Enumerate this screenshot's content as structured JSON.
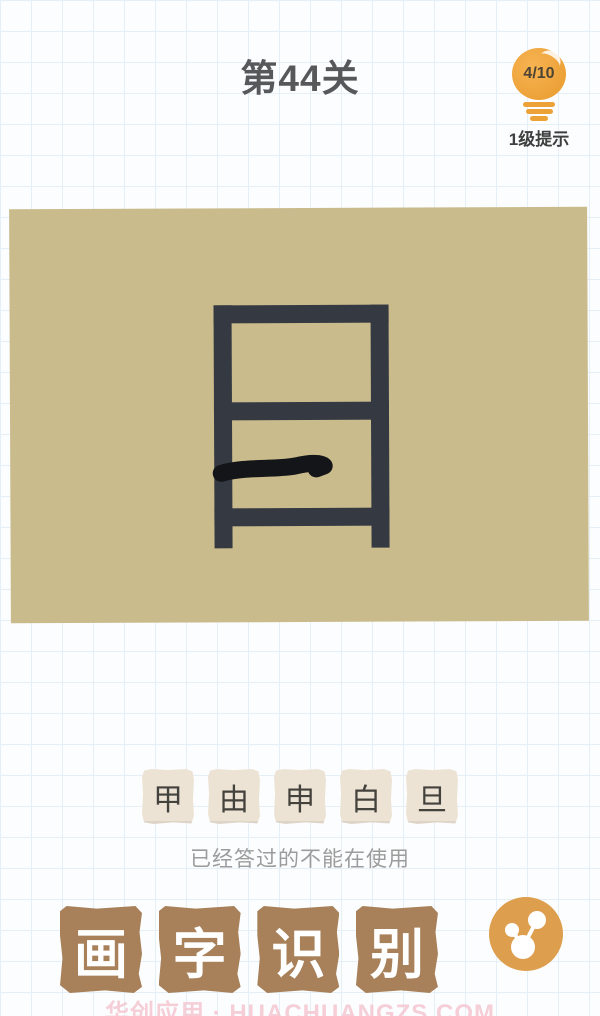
{
  "header": {
    "level_title": "第44关",
    "hint": {
      "count": "4/10",
      "label": "1级提示",
      "icon": "lightbulb-icon"
    }
  },
  "puzzle": {
    "base_shape": "日-frame with vertical strokes extending below",
    "player_stroke": "hand-drawn horizontal line in lower section"
  },
  "tiles": {
    "options": [
      "甲",
      "由",
      "申",
      "白",
      "旦"
    ]
  },
  "helper_text": "已经答过的不能在使用",
  "brand": {
    "blocks": [
      "画",
      "字",
      "识",
      "别"
    ]
  },
  "share": {
    "icon": "share-icon"
  },
  "watermark": "华创应用 · HUACHUANGZS.COM",
  "colors": {
    "page_bg": "#fcfdfe",
    "grid_line": "#e6eff5",
    "title_text": "#57585a",
    "bulb_orange": "#eda238",
    "canvas_bg": "#c9bb8c",
    "glyph": "#343942",
    "hand_stroke": "#141518",
    "tile_bg": "#ece3d5",
    "tile_text": "#44423c",
    "helper_text": "#9c9c9c",
    "block_bg": "#a8815a",
    "block_text": "#ffffff",
    "accent_orange": "#dd9e4e",
    "watermark": "#f3bfcb"
  }
}
